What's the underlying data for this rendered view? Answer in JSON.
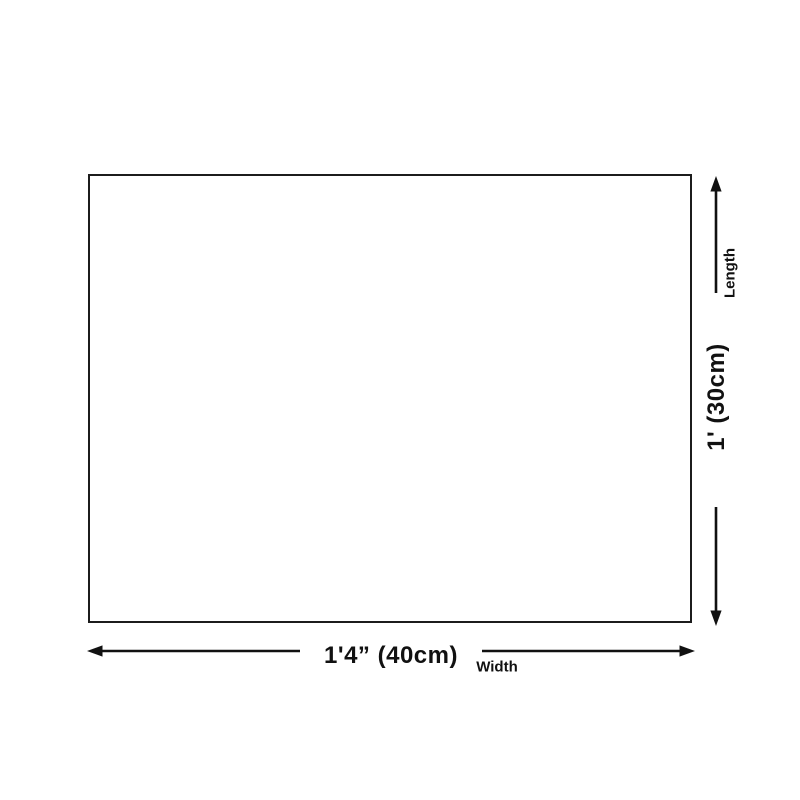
{
  "colors": {
    "line": "#111111",
    "background": "#ffffff",
    "rect_border": "#1c1c1c",
    "rect_fill": "#ffffff"
  },
  "diagram": {
    "width_dimension": {
      "value": "1'4” (40cm)",
      "caption": "Width"
    },
    "length_dimension": {
      "value": "1' (30cm)",
      "caption": "Length"
    }
  }
}
